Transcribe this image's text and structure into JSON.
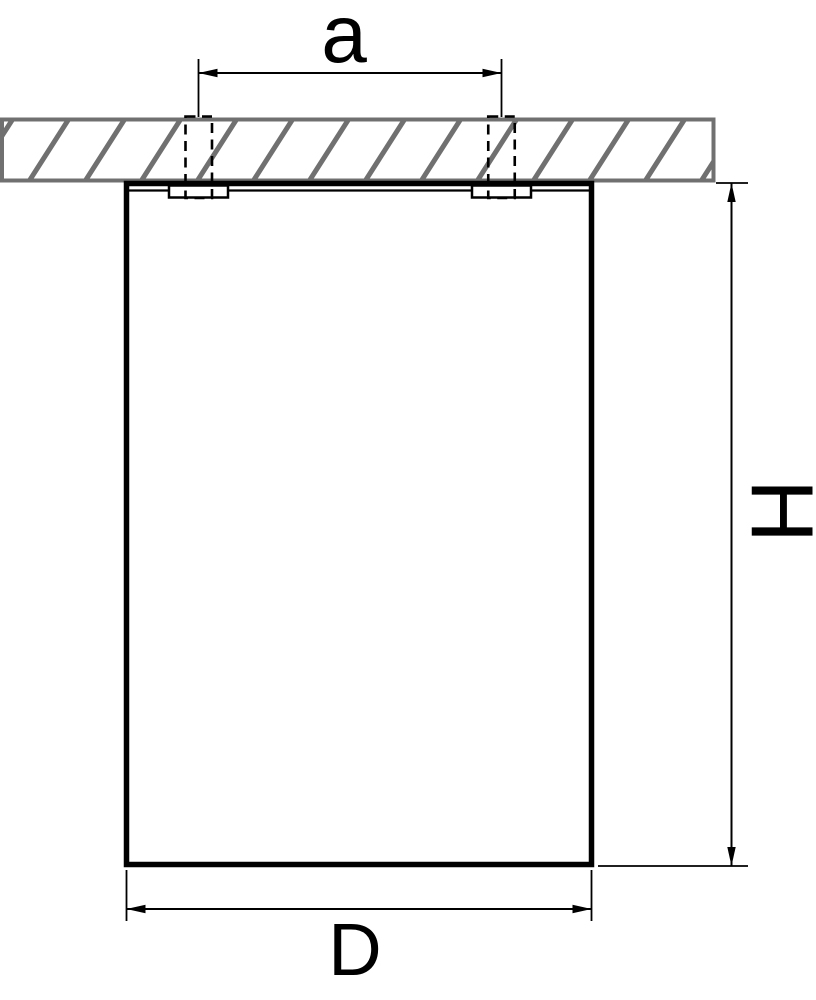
{
  "diagram": {
    "labels": {
      "hole_spacing": "a",
      "height": "H",
      "diameter": "D"
    },
    "colors": {
      "line": "#000000",
      "ceiling_gray": "#707070",
      "background": "#ffffff"
    }
  }
}
